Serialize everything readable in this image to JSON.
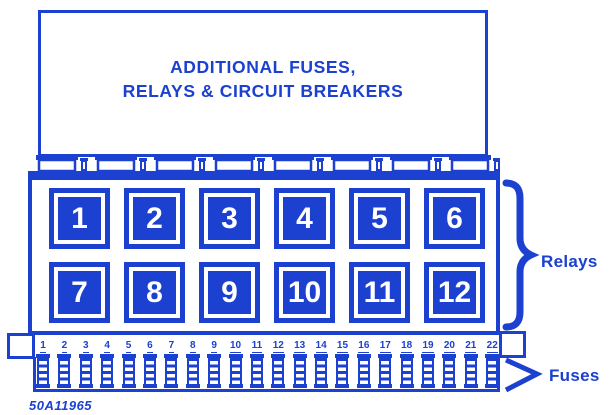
{
  "diagram": {
    "title_line1": "ADDITIONAL FUSES,",
    "title_line2": "RELAYS & CIRCUIT BREAKERS",
    "relays_label": "Relays",
    "fuses_label": "Fuses",
    "part_number": "50A11965",
    "relay_numbers": [
      "1",
      "2",
      "3",
      "4",
      "5",
      "6",
      "7",
      "8",
      "9",
      "10",
      "11",
      "12"
    ],
    "fuse_numbers": [
      "1",
      "2",
      "3",
      "4",
      "5",
      "6",
      "7",
      "8",
      "9",
      "10",
      "11",
      "12",
      "13",
      "14",
      "15",
      "16",
      "17",
      "18",
      "19",
      "20",
      "21",
      "22"
    ],
    "colors": {
      "blue": "#1c40cf",
      "background": "#ffffff"
    }
  }
}
